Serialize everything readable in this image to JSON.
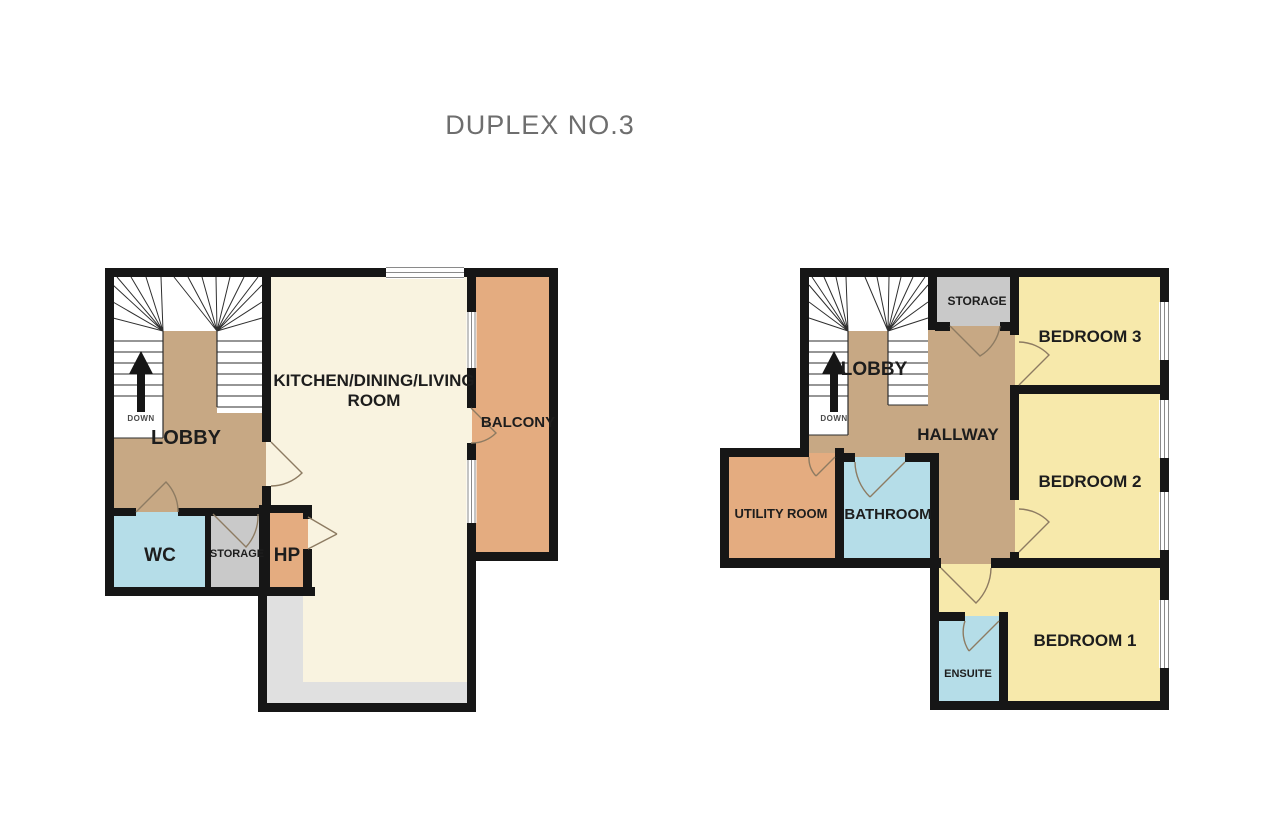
{
  "title": "DUPLEX NO.3",
  "colors": {
    "wall": "#161616",
    "tan": "#c7a884",
    "cream": "#f9f3e0",
    "yellow": "#f7e9ab",
    "orange": "#e4ac80",
    "blue": "#b5dde8",
    "gray": "#c9c9c9",
    "floor_gray": "#e0e0e0",
    "stair_line": "#2e2e2e",
    "door_line": "#8d7b62",
    "window_line": "#8a8a8a",
    "label": "#1d1d1d",
    "muted_label": "#4a4a4a",
    "title_color": "#6e6e6e"
  },
  "ground_floor": {
    "rooms": {
      "lobby": "LOBBY",
      "kitchen_line1": "KITCHEN/DINING/LIVING",
      "kitchen_line2": "ROOM",
      "balcony": "BALCONY",
      "wc": "WC",
      "storage": "STORAGE",
      "hp": "HP"
    },
    "stairs_label": "DOWN"
  },
  "first_floor": {
    "rooms": {
      "lobby": "LOBBY",
      "storage": "STORAGE",
      "bedroom3": "BEDROOM 3",
      "hallway": "HALLWAY",
      "bedroom2": "BEDROOM 2",
      "utility": "UTILITY ROOM",
      "bathroom": "BATHROOM",
      "bedroom1": "BEDROOM 1",
      "ensuite": "ENSUITE"
    },
    "stairs_label": "DOWN"
  }
}
